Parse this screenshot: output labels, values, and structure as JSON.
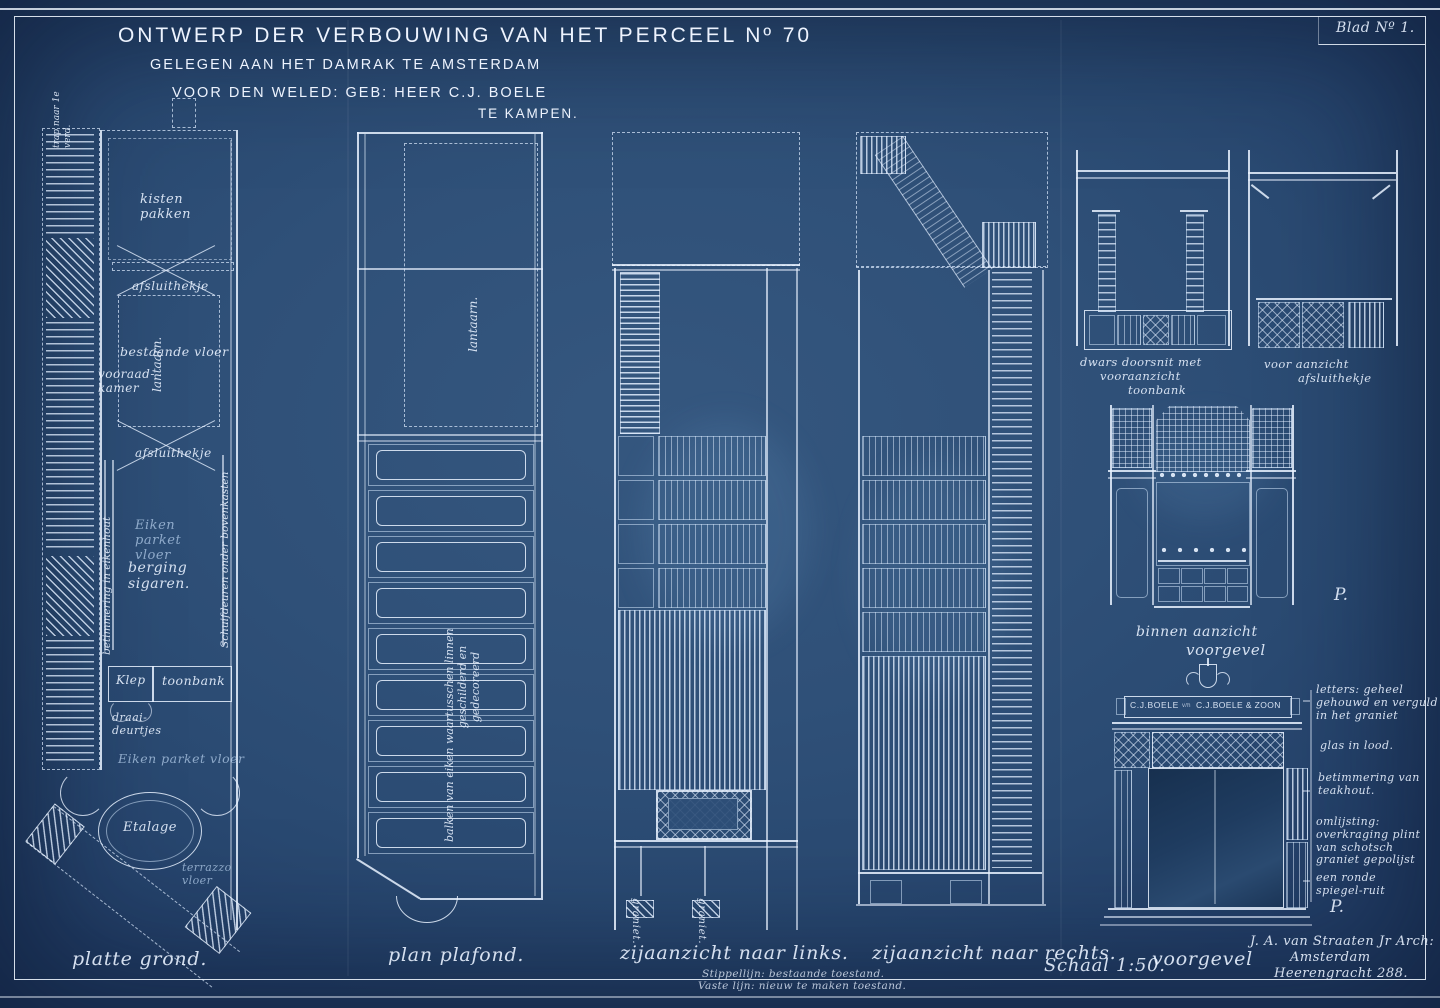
{
  "colors": {
    "paper": "#2f5078",
    "line": "#e3edfc",
    "accent_soft": "#b9d4f0"
  },
  "sheet": {
    "blad": "Blad Nº 1."
  },
  "title": {
    "line1": "ONTWERP DER VERBOUWING VAN HET PERCEEL Nº 70",
    "line2": "GELEGEN AAN HET DAMRAK TE AMSTERDAM",
    "line3": "VOOR DEN WELED: GEB: HEER  C.J. BOELE",
    "line4": "TE KAMPEN."
  },
  "plattegrond": {
    "caption": "platte grond.",
    "trap": "trap naar 1e verd.",
    "kisten": "kisten pakken",
    "afsluithekje_1": "afsluithekje",
    "lantaarn": "lantaarn.",
    "bestaande_vloer": "bestaande vloer",
    "vooraadkamer": "vooraad- kamer",
    "afsluithekje_2": "afsluithekje",
    "betimmering": "betimmering in eikenhout",
    "eiken_parket_1": "Eiken parket vloer",
    "berging": "berging sigaren.",
    "schuifdeuren": "Schuifdeuren onder bovenkasten",
    "klep": "Klep",
    "toonbank": "toonbank",
    "draaideurtjes": "draai- deurtjes",
    "eiken_parket_2": "Eiken parket vloer",
    "etalage": "Etalage",
    "terrazzo": "terrazzo vloer"
  },
  "plafond": {
    "caption": "plan plafond.",
    "lantaarn": "lantaarn.",
    "note_1": "balken van eiken waartusschen linnen",
    "note_2": "geschilderd en",
    "note_3": "gedecoreerd"
  },
  "zij_links": {
    "caption": "zijaanzicht naar links.",
    "graniet_1": "graniet.",
    "graniet_2": "graniet.",
    "legend_1": "Stippellijn: bestaande toestand.",
    "legend_2": "Vaste lijn: nieuw te maken toestand."
  },
  "zij_rechts": {
    "caption": "zijaanzicht naar rechts."
  },
  "schaal": "Schaal 1:50.",
  "sectie_toonbank": {
    "label_1": "dwars doorsnit met",
    "label_2": "vooraanzicht",
    "label_3": "toonbank"
  },
  "aanzicht_hekje": {
    "label_1": "voor aanzicht",
    "label_2": "afsluithekje"
  },
  "binnen_aanzicht": {
    "label_1": "binnen aanzicht",
    "label_2": "voorgevel",
    "p_mark": "P."
  },
  "voorgevel": {
    "caption": "voorgevel",
    "sign_left": "C.J.BOELE",
    "sign_mid": "v/h",
    "sign_right": "C.J.BOELE & ZOON",
    "p_mark": "P.",
    "notes": [
      "letters: geheel gehouwd en verguld in het graniet",
      "glas in lood.",
      "betimmering van teakhout.",
      "omlijsting: overkraging plint van schotsch graniet gepolijst",
      "een ronde spiegel-ruit"
    ]
  },
  "signature": {
    "line1": "J. A. van Straaten Jr Arch:",
    "line2": "Amsterdam",
    "line3": "Heerengracht 288."
  }
}
